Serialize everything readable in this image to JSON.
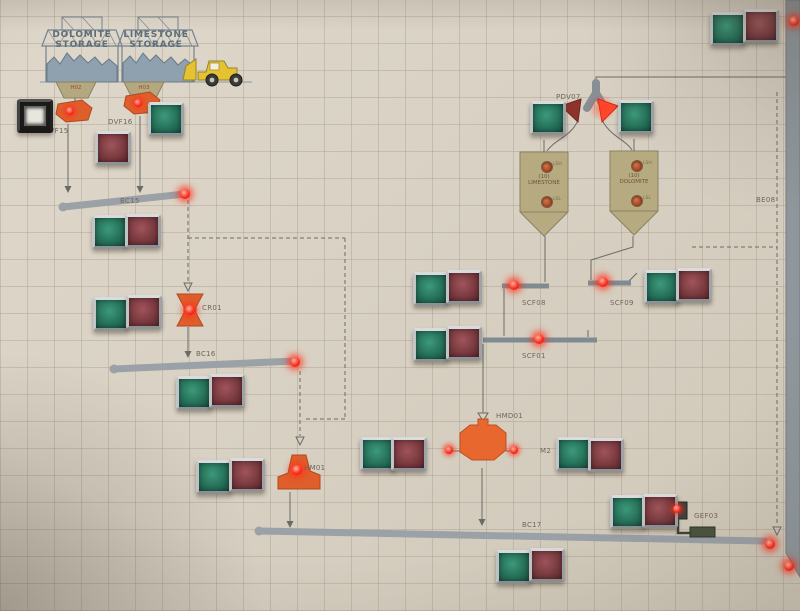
{
  "sheds": {
    "left": {
      "l1": "DOLOMITE",
      "l2": "STORAGE",
      "hopper": "H02"
    },
    "right": {
      "l1": "LIMESTONE",
      "l2": "STORAGE",
      "hopper": "H03"
    }
  },
  "feeders": {
    "left": "DVF15",
    "right": "DVF16"
  },
  "conveyors": {
    "bc15": "BC15",
    "bc16": "BC16",
    "bc17": "BC17",
    "elevator": "BE08"
  },
  "crushers": {
    "primary": "CR01",
    "secondary": "HM01",
    "mill": "HMD01"
  },
  "motors": {
    "m1": "M1",
    "m2": "M2"
  },
  "diverter": {
    "label": "PDV07"
  },
  "silos": {
    "left": {
      "l1": "(10)",
      "l2": "LIMESTONE",
      "high": "LSH",
      "low": "LSL"
    },
    "right": {
      "l1": "(10)",
      "l2": "DOLOMITE",
      "high": "LSH",
      "low": "LSL"
    }
  },
  "screws": {
    "s1": "SCF08",
    "s2": "SCF09",
    "s3": "SCF01"
  },
  "separator": {
    "label": "GEF03"
  },
  "colors": {
    "equipment_orange": "#df5f2c",
    "lamp_red": "#ff2e1e",
    "button_green": "#2d7d63",
    "button_maroon": "#6e3338",
    "silo_tan": "#b6aa81",
    "conveyor_gray": "#9aa1a7",
    "panel_beige": "#d8d1c4"
  }
}
